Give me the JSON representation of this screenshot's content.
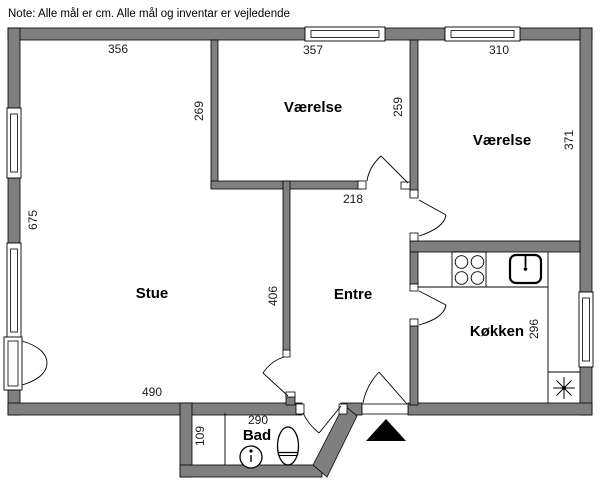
{
  "note": "Note: Alle mål er cm. Alle mål og inventar er vejledende",
  "floorplan": {
    "rooms": {
      "stue": "Stue",
      "vaerelse1": "Værelse",
      "vaerelse2": "Værelse",
      "entre": "Entre",
      "koekken": "Køkken",
      "bad": "Bad"
    },
    "measurements": {
      "stue_top_width": "356",
      "vaerelse1_width": "357",
      "vaerelse2_width": "310",
      "vaerelse1_left_height": "269",
      "vaerelse1_right_height": "259",
      "vaerelse2_height": "371",
      "stue_left_height": "675",
      "entre_top_width": "218",
      "entre_left_height": "406",
      "koekken_height": "296",
      "stue_bottom_width": "490",
      "bad_left_height": "109",
      "bad_width": "290"
    },
    "colors": {
      "wall": "#7f7f7f",
      "outline": "#000000",
      "background": "#ffffff"
    }
  }
}
